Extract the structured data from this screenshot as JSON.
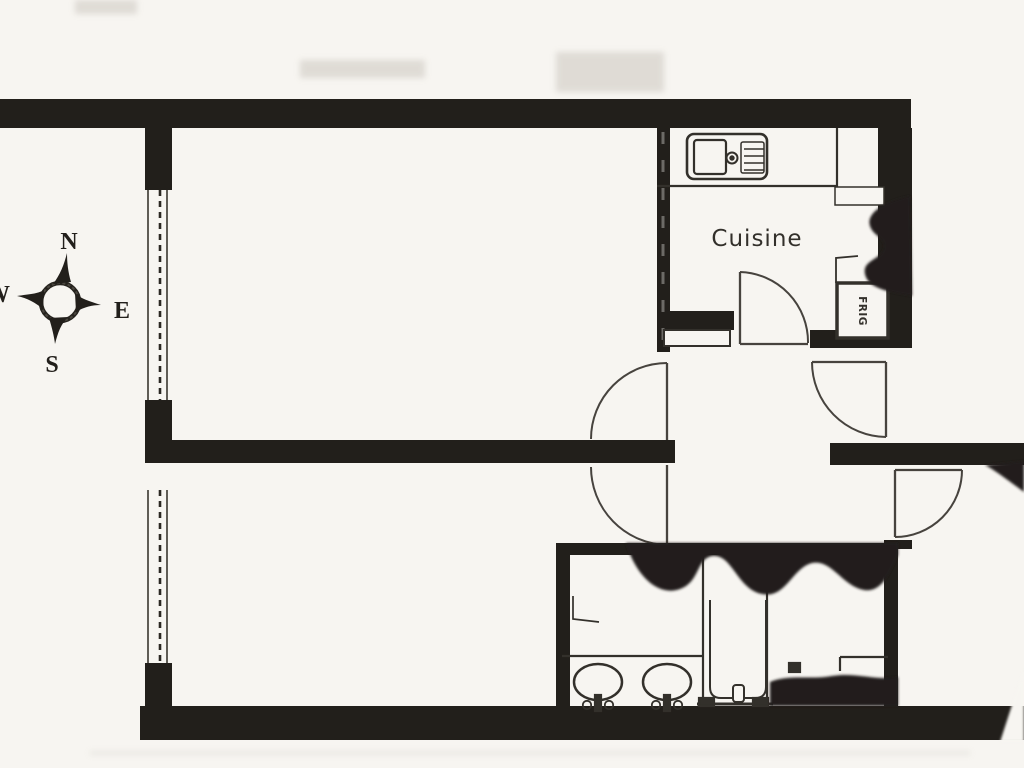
{
  "plan": {
    "compass": {
      "north": "N",
      "east": "E",
      "south": "S",
      "west": "W"
    },
    "rooms": {
      "kitchen": "Cuisine"
    },
    "appliances": {
      "fridge": "FRIG"
    },
    "colors": {
      "paper": "#f7f5f1",
      "wall": "#221f1b",
      "line": "#33302b",
      "artifact": "#d9d5cf"
    }
  }
}
